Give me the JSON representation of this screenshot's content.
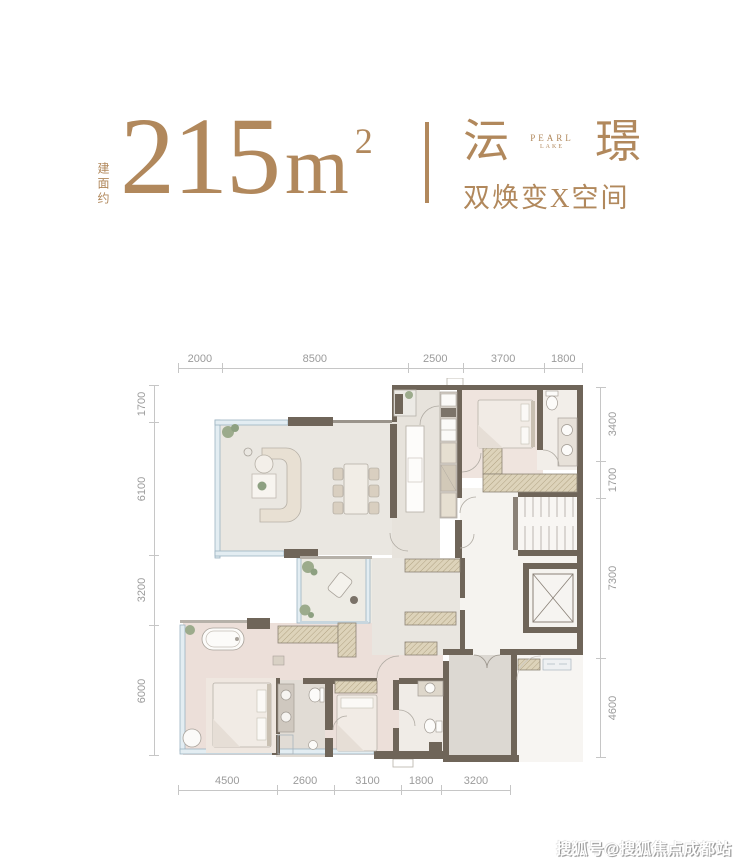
{
  "header": {
    "area_label": "建面约",
    "area_number": "215",
    "area_unit": "m",
    "area_exponent": "2",
    "brand_left": "沄",
    "brand_right": "璟",
    "logo_word_top": "PEARL",
    "logo_word_bottom": "LAKE",
    "tagline": "双焕变X空间"
  },
  "floorplan": {
    "dims_top": [
      "2000",
      "8500",
      "2500",
      "3700",
      "1800"
    ],
    "dims_left": [
      "1700",
      "6100",
      "3200",
      "6000"
    ],
    "dims_right": [
      "3400",
      "1700",
      "7300",
      "4600"
    ],
    "dims_bottom": [
      "4500",
      "2600",
      "3100",
      "1800",
      "3200"
    ]
  },
  "watermark": {
    "text": "搜狐号@搜狐焦点成都站"
  },
  "colors": {
    "accent": "#b1885c",
    "dimension_text": "#9b9b9b",
    "wall": "#6f6559",
    "window_frame": "#9cb2c1",
    "hatch_fill": "#ddd3ba",
    "wood_floor": "#ecdfd9",
    "stone_floor": "#eae7e1",
    "entry_floor": "#dcd8d2"
  }
}
